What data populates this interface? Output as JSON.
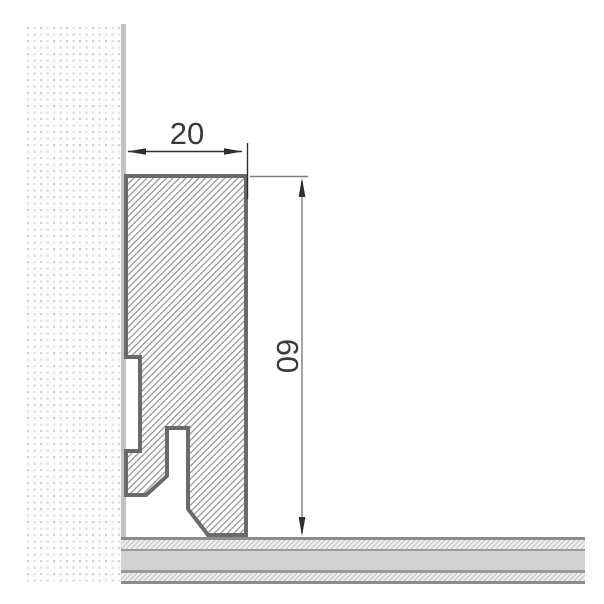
{
  "diagram": {
    "type": "technical-drawing",
    "subject": "skirting-board profile cross-section mounted on wall above floor",
    "dimensions": {
      "width_label": "20",
      "height_label": "60"
    },
    "parts": {
      "wall": "stippled wall (plaster texture)",
      "wall_strip": "wall finish surface strip",
      "profile": "skirting board section (diagonal hatch) with clip recess and cable channel cutout",
      "floor": "floor build-up: hatched layer, core layer, hatched layer"
    },
    "colors": {
      "background": "#ffffff",
      "profile_border": "#6a6a6a",
      "hatch_line": "#9f9f9f",
      "wall_strip": "#c2c2c2",
      "wall_dot_dark": "#d2d2d2",
      "wall_dot_light": "#e4e4e4",
      "floor_core": "#d2d2d2",
      "floor_line": "#8c8c8c",
      "floor_hatch_bg": "#ededed",
      "floor_hatch_line": "#c4c4c4",
      "dim_dark": "#2f2f2f",
      "dim_gray": "#9a9a9a",
      "ext_gray": "#7e7e7e",
      "text": "#3a3a3a"
    }
  }
}
